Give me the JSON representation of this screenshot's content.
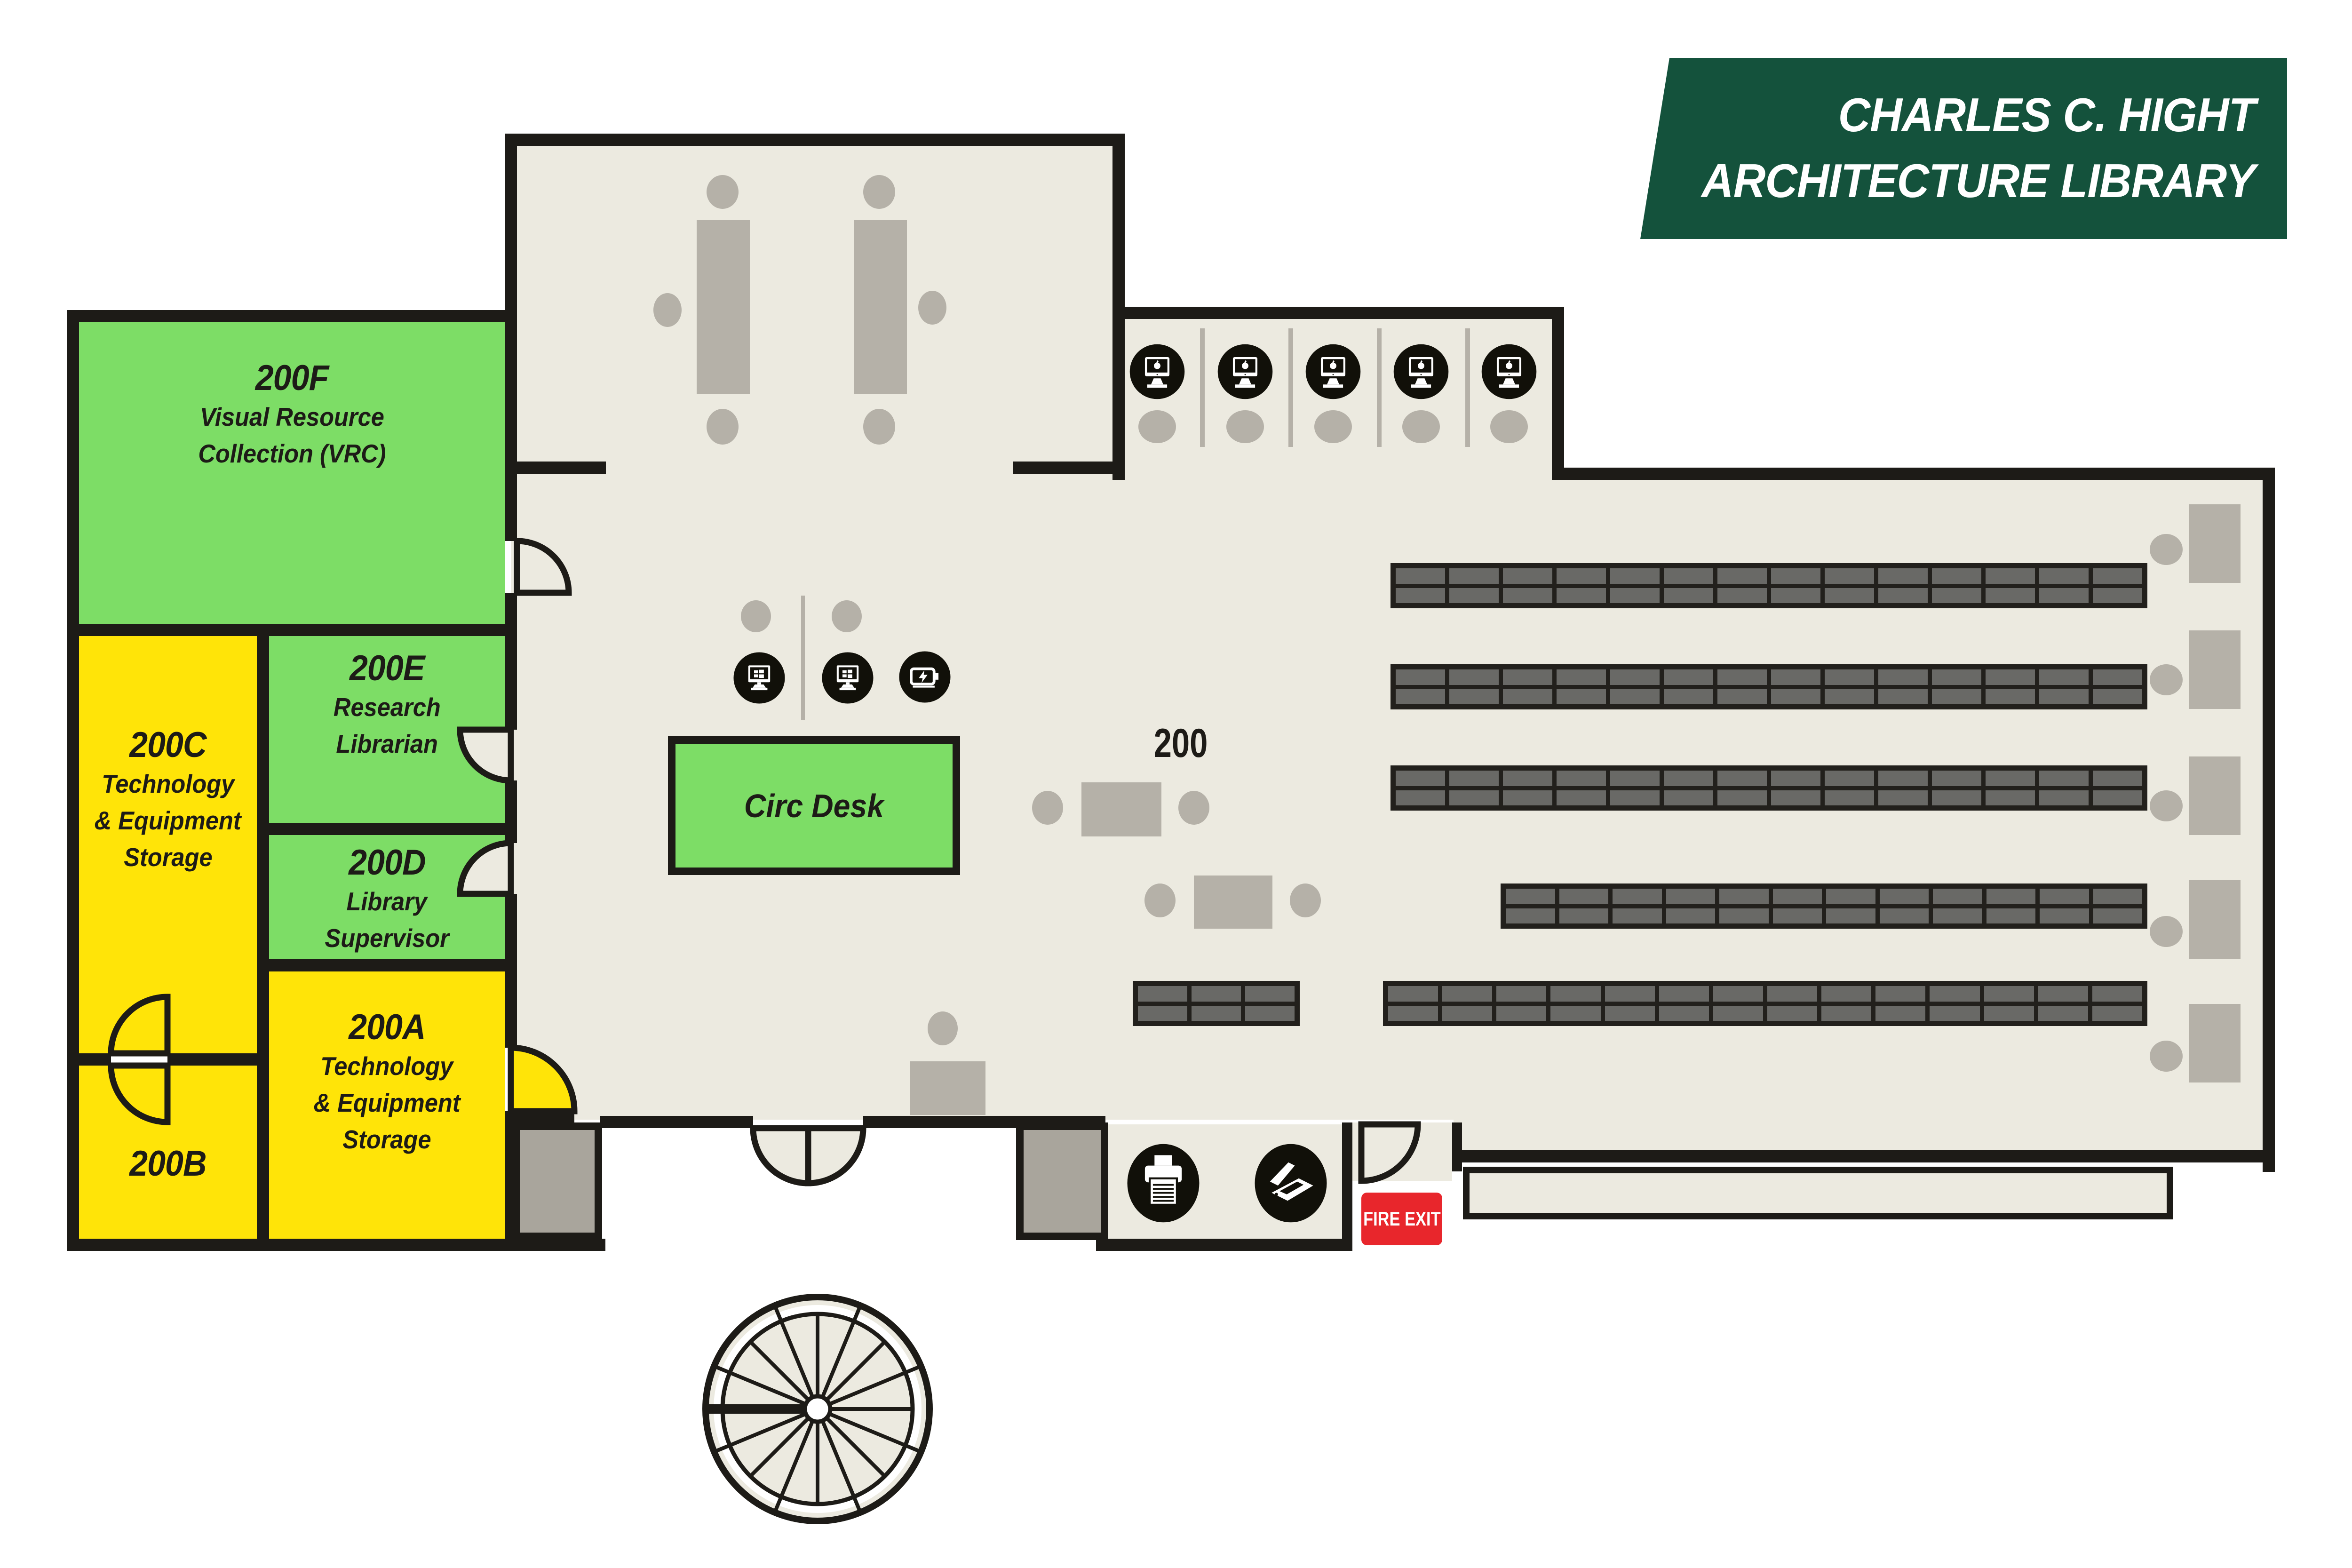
{
  "title_banner": {
    "line1": "CHARLES C. HIGHT",
    "line2": "ARCHITECTURE LIBRARY"
  },
  "rooms": {
    "f": {
      "num": "200F",
      "line1": "Visual Resource",
      "line2": "Collection (VRC)"
    },
    "c": {
      "num": "200C",
      "line1": "Technology",
      "line2": "& Equipment",
      "line3": "Storage"
    },
    "e": {
      "num": "200E",
      "line1": "Research",
      "line2": "Librarian"
    },
    "d": {
      "num": "200D",
      "line1": "Library",
      "line2": "Supervisor"
    },
    "a": {
      "num": "200A",
      "line1": "Technology",
      "line2": "& Equipment",
      "line3": "Storage"
    },
    "b": {
      "num": "200B"
    }
  },
  "labels": {
    "circ_desk": "Circ Desk",
    "main_area": "200",
    "fire_exit": "FIRE EXIT"
  },
  "icons": {
    "apple_computer_station": "apple-computer-icon",
    "windows_computer_station": "windows-computer-icon",
    "battery_charging_station": "battery-charging-icon",
    "printer": "printer-icon",
    "scanner": "scanner-icon"
  },
  "equipment_counts": {
    "apple_computer_stations": 5,
    "windows_computer_stations": 2,
    "battery_charging_stations": 1,
    "printers": 1,
    "scanners": 1
  },
  "colors": {
    "room_green": "#7DDD66",
    "room_yellow": "#FFE408",
    "banner_green": "#14523C",
    "floor_beige": "#ECEAE0",
    "wall_black": "#1D1B17",
    "furniture_gray": "#B5B1A8",
    "fire_exit_red": "#E8262C"
  }
}
